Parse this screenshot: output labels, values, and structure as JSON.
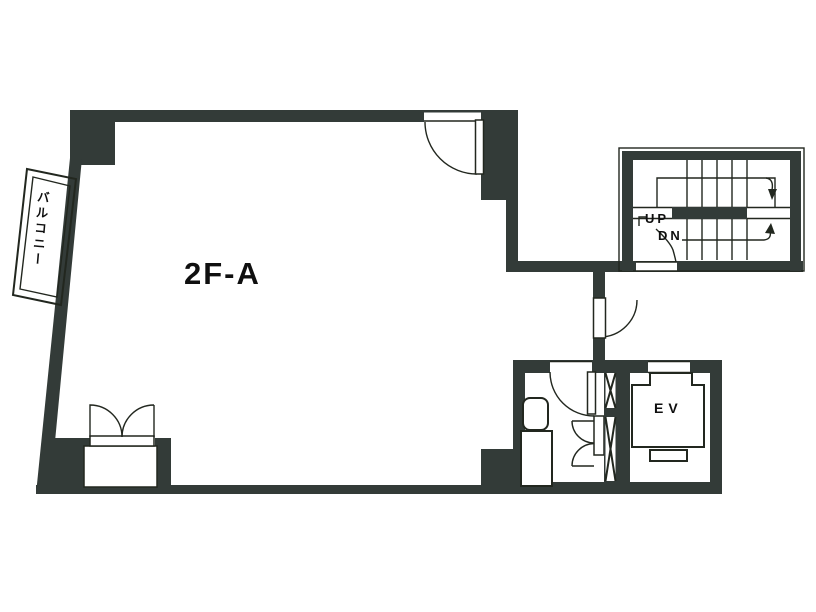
{
  "title": "2F-A floor plan",
  "labels": {
    "room": "2F-A",
    "balcony": "バルコニー",
    "stairs_up": "UP",
    "stairs_down": "DN",
    "elevator": "EV"
  },
  "colors": {
    "wall": "#333b38",
    "line": "#22271f",
    "background": "#ffffff",
    "text": "#0f0f0f"
  }
}
